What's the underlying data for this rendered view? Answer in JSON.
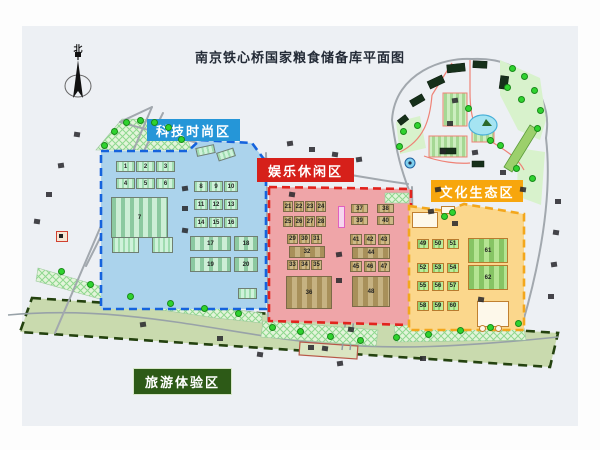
{
  "title": "南京铁心桥国家粮食储备库平面图",
  "compass": {
    "north_label": "北"
  },
  "zones": {
    "tech": {
      "label": "科技时尚区",
      "badge_bg": "#2596d8",
      "area_fill": "#abd3ec",
      "area_border": "#1563dd",
      "buildings": [
        "1",
        "2",
        "3",
        "4",
        "5",
        "6",
        "7",
        "8",
        "9",
        "10",
        "11",
        "12",
        "13",
        "14",
        "15",
        "16",
        "17",
        "18",
        "19",
        "20"
      ]
    },
    "leisure": {
      "label": "娱乐休闲区",
      "badge_bg": "#d6201a",
      "area_fill": "#efa5a8",
      "area_border": "#e2231d",
      "buildings": [
        "21",
        "22",
        "23",
        "24",
        "25",
        "26",
        "27",
        "28",
        "29",
        "30",
        "31",
        "32",
        "33",
        "34",
        "35",
        "36",
        "37",
        "38",
        "39",
        "40",
        "41",
        "42",
        "43",
        "44",
        "45",
        "46",
        "47",
        "48"
      ]
    },
    "culture": {
      "label": "文化生态区",
      "badge_bg": "#f7a60d",
      "area_fill": "#fbd78c",
      "area_border": "#f3a71c",
      "buildings": [
        "49",
        "50",
        "51",
        "52",
        "53",
        "54",
        "55",
        "56",
        "57",
        "58",
        "59",
        "60",
        "61",
        "62"
      ]
    },
    "tourism": {
      "label": "旅游体验区",
      "badge_bg": "#2d5a17",
      "area_fill": "#c9daae",
      "area_border": "#24420f"
    }
  }
}
